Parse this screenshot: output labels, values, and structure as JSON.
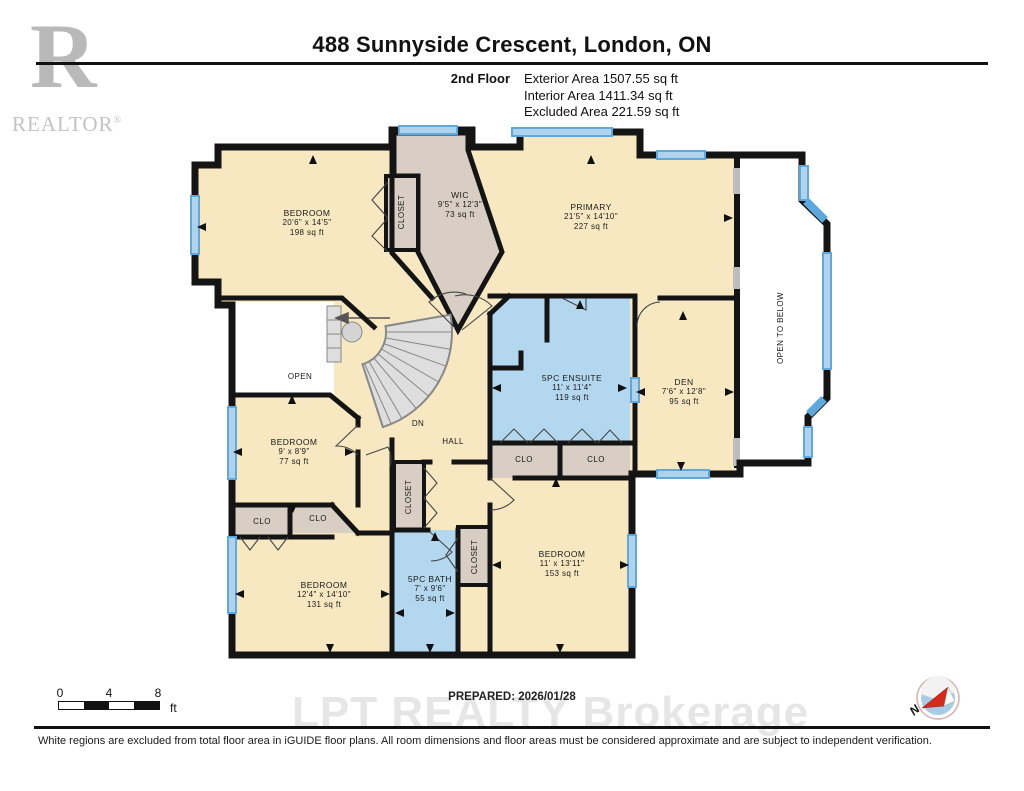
{
  "header": {
    "title": "488 Sunnyside Crescent, London, ON",
    "floor_label": "2nd Floor",
    "stat_exterior": "Exterior Area 1507.55 sq ft",
    "stat_interior": "Interior Area 1411.34 sq ft",
    "stat_excluded": "Excluded Area 221.59 sq ft",
    "logo_letter": "R",
    "logo_text": "REALTOR",
    "logo_reg": "®"
  },
  "rooms": {
    "bedroom_tl": {
      "name": "BEDROOM",
      "dims": "20'6\" x 14'5\"",
      "area": "198 sq ft"
    },
    "closet_tl": {
      "name": "CLOSET"
    },
    "wic": {
      "name": "WIC",
      "dims": "9'5\" x 12'3\"",
      "area": "73 sq ft"
    },
    "primary": {
      "name": "PRIMARY",
      "dims": "21'5\" x 14'10\"",
      "area": "227 sq ft"
    },
    "open_below": {
      "name": "OPEN TO BELOW"
    },
    "ensuite": {
      "name": "5PC ENSUITE",
      "dims": "11' x 11'4\"",
      "area": "119 sq ft"
    },
    "den": {
      "name": "DEN",
      "dims": "7'6\" x 12'8\"",
      "area": "95 sq ft"
    },
    "clo_a": {
      "name": "CLO"
    },
    "clo_b": {
      "name": "CLO"
    },
    "open": {
      "name": "OPEN"
    },
    "dn": {
      "name": "DN"
    },
    "hall": {
      "name": "HALL"
    },
    "bedroom_w": {
      "name": "BEDROOM",
      "dims": "9' x 8'9\"",
      "area": "77 sq ft"
    },
    "clo_c": {
      "name": "CLO"
    },
    "clo_d": {
      "name": "CLO"
    },
    "bedroom_bl": {
      "name": "BEDROOM",
      "dims": "12'4\" x 14'10\"",
      "area": "131 sq ft"
    },
    "closet_mid": {
      "name": "CLOSET"
    },
    "bath": {
      "name": "5PC BATH",
      "dims": "7' x 9'6\"",
      "area": "55 sq ft"
    },
    "closet_rb": {
      "name": "CLOSET"
    },
    "bedroom_br": {
      "name": "BEDROOM",
      "dims": "11' x 13'11\"",
      "area": "153 sq ft"
    }
  },
  "footer": {
    "scale_tick_0": "0",
    "scale_tick_4": "4",
    "scale_tick_8": "8",
    "scale_unit": "ft",
    "prepared": "PREPARED: 2026/01/28",
    "watermark": "LPT REALTY  Brokerage",
    "disclaimer": "White regions are excluded from total floor area in iGUIDE floor plans. All room dimensions and floor areas must be considered approximate and are subject to independent verification.",
    "compass_letter": "N"
  },
  "colors": {
    "room_cream": "#F8E8C2",
    "closet_tan": "#D8CEC3",
    "bath_blue": "#B4D7F0",
    "window_blue": "#5FA8DC",
    "wall_black": "#141414"
  }
}
